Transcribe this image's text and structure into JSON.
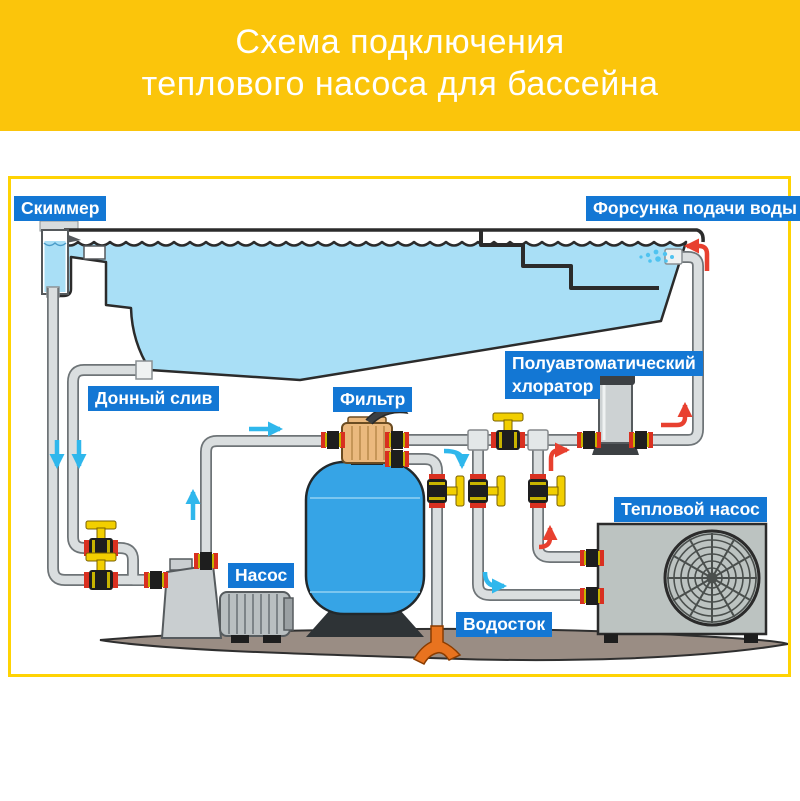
{
  "header": {
    "title_line1": "Схема подключения",
    "title_line2": "теплового насоса для бассейна"
  },
  "diagram": {
    "labels": {
      "skimmer": "Скиммер",
      "inlet_nozzle": "Форсунка подачи воды",
      "bottom_drain": "Донный слив",
      "filter": "Фильтр",
      "chlorinator_line1": "Полуавтоматический",
      "chlorinator_line2": "хлоратор",
      "pump": "Насос",
      "heat_pump": "Тепловой насос",
      "drain": "Водосток"
    },
    "legend": {
      "cold_flow_color": "#2FB7EC",
      "hot_flow_color": "#E8402F"
    },
    "colors": {
      "header_yellow": "#FBC50B",
      "frame_yellow": "#FFD303",
      "label_blue": "#1377D4",
      "water_blue": "#A9DFF6",
      "filter_tank_blue": "#36A4E6",
      "valve_yellow": "#F2CF00",
      "union_red": "#D93020",
      "pipe_gray": "#DADEDF",
      "ground_brown": "#9A8D84",
      "splash_orange": "#E8731F"
    }
  }
}
